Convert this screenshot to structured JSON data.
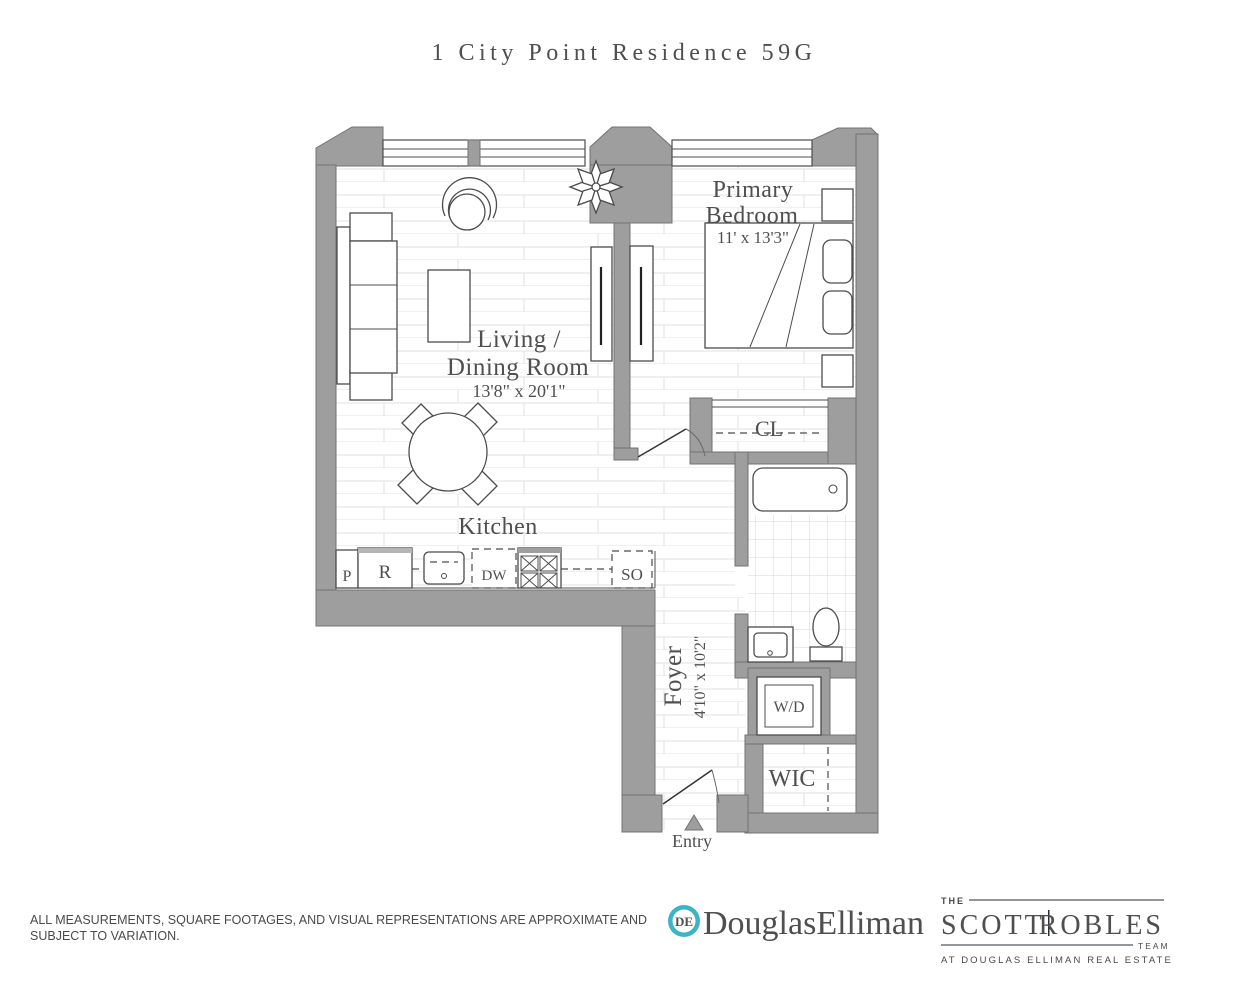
{
  "title": "1 City Point Residence 59G",
  "rooms": {
    "primary_bedroom": {
      "line1": "Primary",
      "line2": "Bedroom",
      "dims": "11' x 13'3\""
    },
    "living_dining": {
      "line1": "Living /",
      "line2": "Dining Room",
      "dims": "13'8\" x 20'1\""
    },
    "kitchen": {
      "label": "Kitchen"
    },
    "foyer": {
      "label": "Foyer",
      "dims": "4'10\" x 10'2\""
    },
    "closet": {
      "label": "CL"
    },
    "washer_dryer": {
      "label": "W/D"
    },
    "walk_in_closet": {
      "label": "WIC"
    },
    "entry": {
      "label": "Entry"
    }
  },
  "kitchen_appliances": {
    "pantry": "P",
    "refrigerator": "R",
    "dishwasher": "DW",
    "stove_oven": "SO"
  },
  "footer": {
    "disclaimer_line1": "ALL MEASUREMENTS, SQUARE FOOTAGES, AND VISUAL REPRESENTATIONS ARE APPROXIMATE AND",
    "disclaimer_line2": "SUBJECT TO VARIATION.",
    "douglas_elliman": {
      "monogram": "DE",
      "wordmark": "DouglasElliman"
    },
    "team": {
      "the": "THE",
      "name_first": "SCOTT",
      "name_last": "ROBLES",
      "team_word": "TEAM",
      "tagline": "AT DOUGLAS ELLIMAN REAL ESTATE"
    }
  },
  "colors": {
    "wall": "#9e9e9e",
    "brand_teal": "#3cb4c7",
    "brand_navy": "#1d2846"
  }
}
